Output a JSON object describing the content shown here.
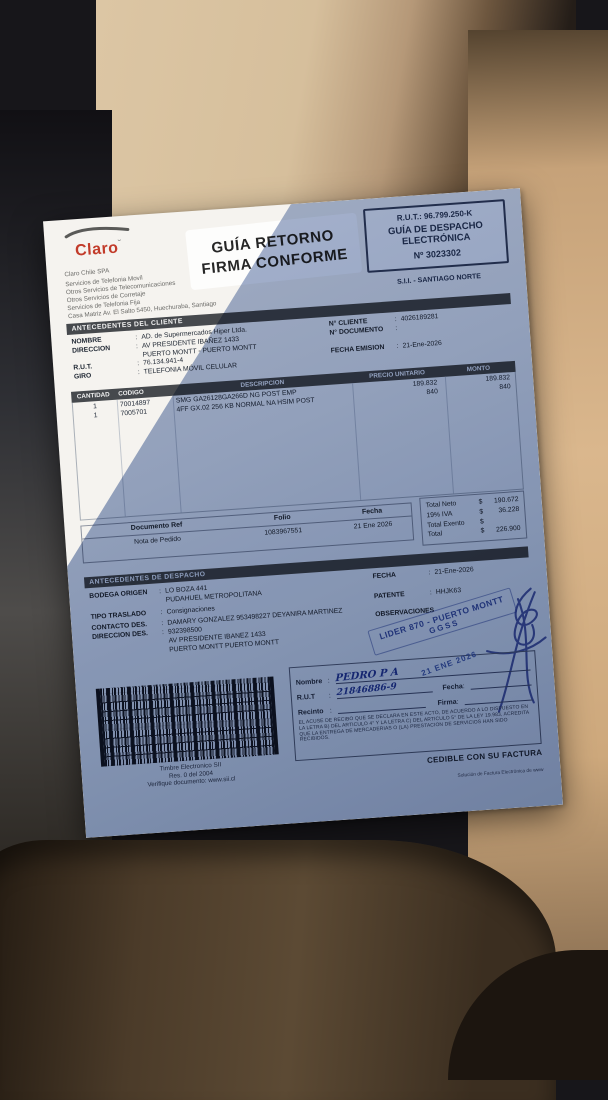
{
  "colors": {
    "brand_red": "#c23b2a",
    "section_bar": "#46494d",
    "stamp_blue": "#2f4a9e",
    "shadow_tint": "#8194b8",
    "paper": "#f5f3ef"
  },
  "ui": {
    "colon": ":"
  },
  "header": {
    "logo": "Claro",
    "issuer_lines": [
      "Claro Chile SPA",
      "Servicios de Telefonia Movil",
      "Otros Servicios de Telecomunicaciones",
      "Otros Servicios de Corretaje",
      "Servicios de Telefonia Fija",
      "Casa Matriz Av. El Salto 5450, Huechuraba, Santiago"
    ],
    "return_stamp": {
      "line1": "GUÍA RETORNO",
      "line2": "FIRMA CONFORME"
    },
    "rut_box": {
      "rut": "R.U.T.: 96.799.250-K",
      "type1": "GUÍA DE DESPACHO",
      "type2": "ELECTRÓNICA",
      "number": "Nº 3023302"
    },
    "sii_office": "S.I.I. - SANTIAGO NORTE"
  },
  "client": {
    "title": "ANTECEDENTES DEL CLIENTE",
    "labels": {
      "nombre": "NOMBRE",
      "direccion": "DIRECCION",
      "rut": "R.U.T.",
      "giro": "GIRO",
      "n_cliente": "N° CLIENTE",
      "n_documento": "N° DOCUMENTO",
      "fecha_emision": "FECHA EMISION"
    },
    "values": {
      "nombre": "AD. de Supermercados Hiper Ltda.",
      "direccion1": "AV PRESIDENTE IBAÑEZ 1433",
      "direccion2": "PUERTO MONTT -  PUERTO MONTT",
      "rut": "76.134.941-4",
      "giro": "TELEFONIA MÓVIL CELULAR",
      "n_cliente": "4026189281",
      "n_documento": "",
      "fecha_emision": "21-Ene-2026"
    }
  },
  "items": {
    "headers": {
      "cantidad": "CANTIDAD",
      "codigo": "CODIGO",
      "descripcion": "DESCRIPCION",
      "precio": "PRECIO UNITARIO",
      "monto": "MONTO"
    },
    "rows": [
      {
        "cantidad": "1",
        "codigo": "70014897",
        "descripcion": "SMG GA26128GA266D NG POST EMP",
        "precio": "189.832",
        "monto": "189.832"
      },
      {
        "cantidad": "1",
        "codigo": "7005701",
        "descripcion": "4FF GX.02 256 KB NORMAL NA HSIM POST",
        "precio": "840",
        "monto": "840"
      }
    ]
  },
  "reference": {
    "h_doc": "Documento Ref",
    "h_folio": "Folio",
    "h_fecha": "Fecha",
    "doc": "Nota de Pedido",
    "folio": "1083967551",
    "fecha": "21 Ene 2026"
  },
  "totals": {
    "currency": "$",
    "neto_label": "Total Neto",
    "neto": "190.672",
    "iva_label": "19% IVA",
    "iva": "36.228",
    "exento_label": "Total Exento",
    "exento": "",
    "total_label": "Total",
    "total": "226.900"
  },
  "dispatch": {
    "title": "ANTECEDENTES DE DESPACHO",
    "labels": {
      "bodega": "BODEGA ORIGEN",
      "tipo": "TIPO TRASLADO",
      "contacto": "CONTACTO DES.",
      "direccion": "DIRECCION DES.",
      "fecha": "FECHA",
      "patente": "PATENTE",
      "observaciones": "OBSERVACIONES"
    },
    "values": {
      "bodega1": "LO BOZA 441",
      "bodega2": "PUDAHUEL   METROPOLITANA",
      "tipo": "Consignaciones",
      "contacto": "DAMARY GONZALEZ 953498227 DEYANIRA MARTINEZ",
      "fecha": "21-Ene-2026",
      "patente": "HHJK63",
      "dir1": "932398500",
      "dir2": "AV PRESIDENTE IBANEZ 1433",
      "dir3": "PUERTO MONTT   PUERTO MONTT"
    }
  },
  "lider_stamp": {
    "line1": "LIDER 870 - PUERTO MONTT",
    "line2": "GGSS"
  },
  "timbre": {
    "line1": "Timbre Electronico SII",
    "line2": "Res. 0 del 2004",
    "line3": "Verifique documento: www.sii.cl"
  },
  "receipt": {
    "labels": {
      "nombre": "Nombre",
      "rut": "R.U.T",
      "recinto": "Recinto",
      "fecha": "Fecha",
      "firma": "Firma"
    },
    "handwritten": {
      "nombre": "PEDRO  P A",
      "rut": "21846886-9"
    },
    "date_stamp": "21 ENE 2026",
    "fine_print": "EL ACUSE DE RECIBO QUE SE DECLARA EN ESTE ACTO, DE ACUERDO A LO DISPUESTO EN LA LETRA B) DEL ARTICULO 4° Y LA LETRA C) DEL ARTICULO 5° DE LA LEY 19.983, ACREDITA QUE LA ENTREGA DE MERCADERIAS O (LA) PRESTACION DE SERVICIOS HAN SIDO RECIBIDOS.",
    "cedible": "CEDIBLE CON SU FACTURA",
    "footer": "Solución de Factura Electrónica de www"
  }
}
